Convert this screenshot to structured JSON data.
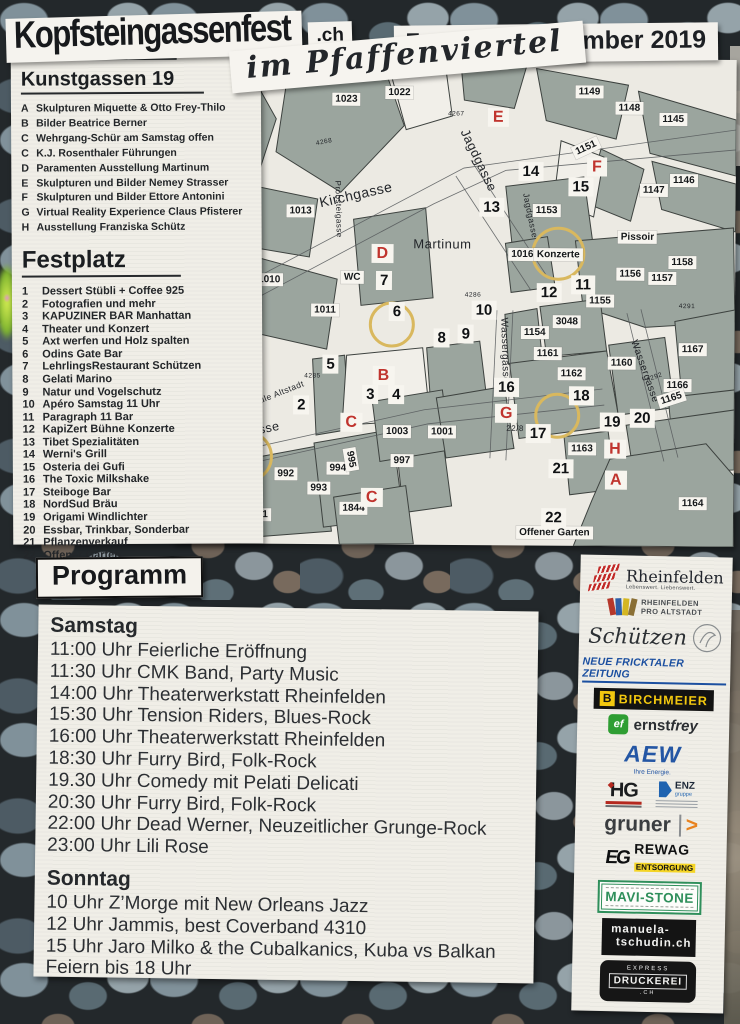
{
  "title": {
    "main": "Kopfsteingassenfest",
    "tld": ".ch",
    "subtitle": "im Pfaffenviertel",
    "date": "7. und 8. September 2019"
  },
  "colors": {
    "marker_red": "#c0342e",
    "circle_yellow": "#d9b85e",
    "map_building_gray": "#9ba59e",
    "nfz_blue": "#1b4fa0",
    "birchmeier_yellow": "#f2c80f",
    "ernstfrey_green": "#2f9e33",
    "aew_blue": "#2456a4",
    "gruner_orange": "#e8821e",
    "rewag_yellow": "#f5d525",
    "mavistone_green": "#2f8f5b"
  },
  "kunstgassen": {
    "heading": "Kunstgassen 19",
    "items": [
      {
        "k": "A",
        "label": "Skulpturen Miquette & Otto Frey-Thilo"
      },
      {
        "k": "B",
        "label": "Bilder Beatrice Berner"
      },
      {
        "k": "C",
        "label": "Wehrgang-Schür am Samstag offen"
      },
      {
        "k": "C",
        "label": "K.J. Rosenthaler Führungen"
      },
      {
        "k": "D",
        "label": "Paramenten Ausstellung Martinum"
      },
      {
        "k": "E",
        "label": "Skulpturen und Bilder Nemey Strasser"
      },
      {
        "k": "F",
        "label": "Skulpturen und Bilder Ettore Antonini"
      },
      {
        "k": "G",
        "label": "Virtual Reality Experience Claus Pfisterer"
      },
      {
        "k": "H",
        "label": "Ausstellung Franziska Schütz"
      }
    ]
  },
  "festplatz": {
    "heading": "Festplatz",
    "items": [
      {
        "n": "1",
        "label": "Dessert Stübli + Coffee 925"
      },
      {
        "n": "2",
        "label": "Fotografien und mehr"
      },
      {
        "n": "3",
        "label": "KAPUZINER BAR Manhattan"
      },
      {
        "n": "4",
        "label": "Theater und Konzert"
      },
      {
        "n": "5",
        "label": "Axt werfen und Holz spalten"
      },
      {
        "n": "6",
        "label": "Odins Gate Bar"
      },
      {
        "n": "7",
        "label": "LehrlingsRestaurant Schützen"
      },
      {
        "n": "8",
        "label": "Gelati Marino"
      },
      {
        "n": "9",
        "label": "Natur und Vogelschutz"
      },
      {
        "n": "10",
        "label": "Apéro Samstag 11 Uhr"
      },
      {
        "n": "11",
        "label": "Paragraph 11 Bar"
      },
      {
        "n": "12",
        "label": "KapiZert Bühne Konzerte"
      },
      {
        "n": "13",
        "label": "Tibet Spezialitäten"
      },
      {
        "n": "14",
        "label": "Werni's Grill"
      },
      {
        "n": "15",
        "label": "Osteria dei Gufi"
      },
      {
        "n": "16",
        "label": "The Toxic Milkshake"
      },
      {
        "n": "17",
        "label": "Steiboge Bar"
      },
      {
        "n": "18",
        "label": "NordSud Bräu"
      },
      {
        "n": "19",
        "label": "Origami Windlichter"
      },
      {
        "n": "20",
        "label": "Essbar, Trinkbar, Sonderbar"
      },
      {
        "n": "21",
        "label": "Pflanzenverkauf"
      },
      {
        "n": "22",
        "label": "Offener Garten"
      }
    ]
  },
  "programm": {
    "heading": "Programm",
    "saturday": {
      "name": "Samstag",
      "events": [
        "11:00 Uhr Feierliche Eröffnung",
        "11:30 Uhr CMK Band, Party Music",
        "14:00 Uhr Theaterwerkstatt Rheinfelden",
        "15:30 Uhr Tension Riders, Blues-Rock",
        "16:00 Uhr Theaterwerkstatt Rheinfelden",
        "18:30 Uhr Furry Bird, Folk-Rock",
        "19.30 Uhr Comedy mit Pelati Delicati",
        "20:30 Uhr Furry Bird, Folk-Rock",
        "22:00 Uhr Dead Werner, Neuzeitlicher Grunge-Rock",
        "23:00 Uhr Lili Rose"
      ]
    },
    "sunday": {
      "name": "Sonntag",
      "events": [
        "10 Uhr Z’Morge mit New Orleans Jazz",
        "12 Uhr Jammis, best Coverband 4310",
        "15 Uhr Jaro Milko & the Cubalkanics, Kuba vs Balkan",
        "Feiern bis 18 Uhr"
      ]
    }
  },
  "map": {
    "chips": [
      {
        "t": "1023",
        "x": 170,
        "y": 42
      },
      {
        "t": "1022",
        "x": 223,
        "y": 35
      },
      {
        "t": "1149",
        "x": 413,
        "y": 33
      },
      {
        "t": "1148",
        "x": 453,
        "y": 49
      },
      {
        "t": "1145",
        "x": 497,
        "y": 60
      },
      {
        "t": "1151",
        "x": 410,
        "y": 89,
        "r": -25
      },
      {
        "t": "1147",
        "x": 478,
        "y": 131
      },
      {
        "t": "1146",
        "x": 508,
        "y": 121
      },
      {
        "t": "1013",
        "x": 125,
        "y": 154
      },
      {
        "t": "1010",
        "x": 94,
        "y": 223
      },
      {
        "t": "1011",
        "x": 150,
        "y": 253
      },
      {
        "t": "1153",
        "x": 371,
        "y": 152
      },
      {
        "t": "1016",
        "x": 347,
        "y": 196
      },
      {
        "t": "Konzerte",
        "x": 383,
        "y": 196
      },
      {
        "t": "1156",
        "x": 455,
        "y": 215
      },
      {
        "t": "1157",
        "x": 487,
        "y": 219
      },
      {
        "t": "1158",
        "x": 507,
        "y": 203
      },
      {
        "t": "1155",
        "x": 425,
        "y": 242
      },
      {
        "t": "3048",
        "x": 392,
        "y": 263
      },
      {
        "t": "1154",
        "x": 360,
        "y": 274
      },
      {
        "t": "1161",
        "x": 373,
        "y": 295
      },
      {
        "t": "1160",
        "x": 447,
        "y": 304
      },
      {
        "t": "1162",
        "x": 397,
        "y": 315
      },
      {
        "t": "1167",
        "x": 518,
        "y": 290
      },
      {
        "t": "1166",
        "x": 503,
        "y": 326
      },
      {
        "t": "1165",
        "x": 497,
        "y": 339,
        "r": -18
      },
      {
        "t": "1163",
        "x": 408,
        "y": 390
      },
      {
        "t": "1164",
        "x": 519,
        "y": 444
      },
      {
        "t": "990",
        "x": 30,
        "y": 459
      },
      {
        "t": "991",
        "x": 86,
        "y": 458
      },
      {
        "t": "992",
        "x": 112,
        "y": 417
      },
      {
        "t": "993",
        "x": 145,
        "y": 431
      },
      {
        "t": "994",
        "x": 164,
        "y": 411
      },
      {
        "t": "995",
        "x": 177,
        "y": 402,
        "r": 80
      },
      {
        "t": "997",
        "x": 228,
        "y": 403
      },
      {
        "t": "1003",
        "x": 223,
        "y": 374
      },
      {
        "t": "1001",
        "x": 268,
        "y": 374
      },
      {
        "t": "1844",
        "x": 180,
        "y": 451
      },
      {
        "t": "WC",
        "x": 177,
        "y": 220
      },
      {
        "t": "Pissoir",
        "x": 462,
        "y": 178
      },
      {
        "t": "Offener Garten",
        "x": 381,
        "y": 474
      }
    ],
    "spots": [
      {
        "t": "1",
        "x": 73,
        "y": 400
      },
      {
        "t": "2",
        "x": 127,
        "y": 348
      },
      {
        "t": "3",
        "x": 196,
        "y": 337
      },
      {
        "t": "4",
        "x": 222,
        "y": 337
      },
      {
        "t": "5",
        "x": 156,
        "y": 307
      },
      {
        "t": "6",
        "x": 222,
        "y": 254
      },
      {
        "t": "7",
        "x": 209,
        "y": 223
      },
      {
        "t": "8",
        "x": 267,
        "y": 280
      },
      {
        "t": "9",
        "x": 291,
        "y": 276
      },
      {
        "t": "10",
        "x": 309,
        "y": 252
      },
      {
        "t": "11",
        "x": 408,
        "y": 226
      },
      {
        "t": "12",
        "x": 374,
        "y": 234
      },
      {
        "t": "13",
        "x": 316,
        "y": 149
      },
      {
        "t": "14",
        "x": 355,
        "y": 113
      },
      {
        "t": "15",
        "x": 405,
        "y": 128
      },
      {
        "t": "16",
        "x": 332,
        "y": 329
      },
      {
        "t": "17",
        "x": 364,
        "y": 375
      },
      {
        "t": "18",
        "x": 407,
        "y": 337
      },
      {
        "t": "19",
        "x": 438,
        "y": 363
      },
      {
        "t": "20",
        "x": 468,
        "y": 359
      },
      {
        "t": "21",
        "x": 387,
        "y": 410
      },
      {
        "t": "22",
        "x": 380,
        "y": 459
      }
    ],
    "letters": [
      {
        "t": "A",
        "x": 34,
        "y": 423
      },
      {
        "t": "A",
        "x": 442,
        "y": 421
      },
      {
        "t": "B",
        "x": 209,
        "y": 318
      },
      {
        "t": "C",
        "x": 177,
        "y": 365
      },
      {
        "t": "C",
        "x": 198,
        "y": 440
      },
      {
        "t": "D",
        "x": 207,
        "y": 196
      },
      {
        "t": "E",
        "x": 322,
        "y": 59
      },
      {
        "t": "F",
        "x": 421,
        "y": 108
      },
      {
        "t": "G",
        "x": 332,
        "y": 355
      },
      {
        "t": "H",
        "x": 441,
        "y": 390
      }
    ],
    "plain": [
      {
        "t": "Kirchgasse",
        "x": 180,
        "y": 137,
        "r": -13,
        "s": 14
      },
      {
        "t": "Jagdgasse",
        "x": 303,
        "y": 102,
        "r": 64,
        "s": 13
      },
      {
        "t": "Jagdgasse",
        "x": 355,
        "y": 157,
        "r": 78,
        "s": 8.5
      },
      {
        "t": "Probsteigasse",
        "x": 163,
        "y": 152,
        "r": 88,
        "s": 8
      },
      {
        "t": "Wassergasse",
        "x": 330,
        "y": 292,
        "r": 88,
        "s": 10
      },
      {
        "t": "Wassergasse",
        "x": 470,
        "y": 312,
        "r": 70,
        "s": 10
      },
      {
        "t": "Kapuzinergasse",
        "x": 58,
        "y": 379,
        "r": -12,
        "s": 12.5
      },
      {
        "t": "Fahnenparade Schule Altstadt",
        "x": 70,
        "y": 350,
        "r": -22,
        "s": 8.5
      },
      {
        "t": "Martinum",
        "x": 267,
        "y": 186,
        "s": 13
      },
      {
        "t": "4267",
        "x": 280,
        "y": 56,
        "s": 6.5
      },
      {
        "t": "4268",
        "x": 148,
        "y": 85,
        "r": -12,
        "s": 6.5
      },
      {
        "t": "4286",
        "x": 298,
        "y": 237,
        "s": 6.5
      },
      {
        "t": "4285",
        "x": 138,
        "y": 319,
        "s": 6.5
      },
      {
        "t": "4291",
        "x": 512,
        "y": 247,
        "s": 6.5
      },
      {
        "t": "4292",
        "x": 480,
        "y": 318,
        "r": -20,
        "s": 6.5
      },
      {
        "t": "22/8",
        "x": 341,
        "y": 370,
        "s": 8
      }
    ],
    "circles": [
      {
        "x": 73,
        "y": 400,
        "d": 46
      },
      {
        "x": 217,
        "y": 267,
        "d": 40
      },
      {
        "x": 383,
        "y": 195,
        "d": 48
      },
      {
        "x": 383,
        "y": 357,
        "d": 40
      }
    ]
  },
  "sponsors": {
    "rheinfelden": {
      "name": "Rheinfelden",
      "tagline": "Lebenswert. Liebenswert."
    },
    "pro_altstadt": {
      "line1": "RHEINFELDEN",
      "line2": "PRO ALTSTADT"
    },
    "schuetzen": {
      "name": "Schützen"
    },
    "nfz": {
      "name": "NEUE FRICKTALER ZEITUNG"
    },
    "birchmeier": {
      "b": "B",
      "name": "BIRCHMEIER"
    },
    "ernstfrey": {
      "ef": "ef",
      "name1": "ernst",
      "name2": "frey"
    },
    "aew": {
      "name": "AEW",
      "tagline": "Ihre Energie."
    },
    "hg": {
      "name": "HG"
    },
    "enz": {
      "name": "ENZ",
      "sub": "gruppe"
    },
    "gruner": {
      "name": "gruner",
      "arrow": ">"
    },
    "rewag": {
      "icon": "EG",
      "name": "REWAG",
      "sub": "ENTSORGUNG"
    },
    "mavistone": {
      "name": "MAVI-STONE"
    },
    "tschudin": {
      "line1": "manuela-",
      "line2": "tschudin.ch"
    },
    "druckerei": {
      "top": "EXPRESS",
      "name": "DRUCKEREI",
      "sub": ".CH"
    }
  }
}
